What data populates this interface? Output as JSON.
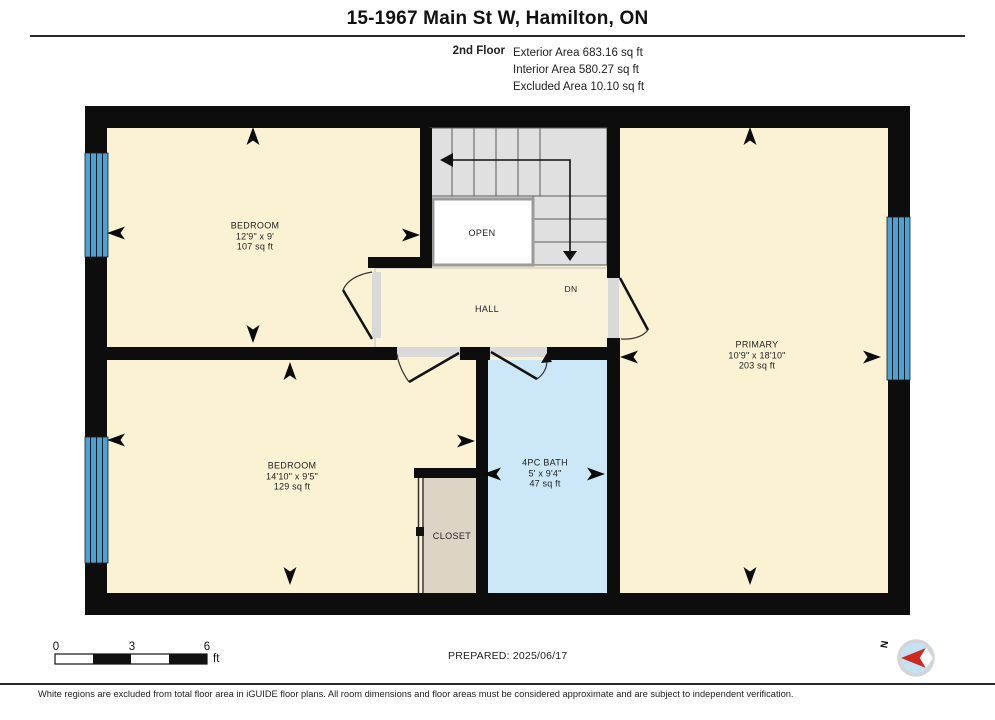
{
  "title": "15-1967 Main St W, Hamilton, ON",
  "floor": {
    "name": "2nd Floor",
    "exterior": "Exterior Area 683.16 sq ft",
    "interior": "Interior Area 580.27 sq ft",
    "excluded": "Excluded Area 10.10 sq ft"
  },
  "rooms": {
    "bedroom1": {
      "name": "BEDROOM",
      "dims": "12'9\" x 9'",
      "area": "107 sq ft"
    },
    "bedroom2": {
      "name": "BEDROOM",
      "dims": "14'10\" x 9'5\"",
      "area": "129 sq ft"
    },
    "primary": {
      "name": "PRIMARY",
      "dims": "10'9\" x 18'10\"",
      "area": "203 sq ft"
    },
    "bath": {
      "name": "4PC BATH",
      "dims": "5' x 9'4\"",
      "area": "47 sq ft"
    },
    "hall": {
      "name": "HALL"
    },
    "open": {
      "name": "OPEN"
    },
    "closet": {
      "name": "CLOSET"
    },
    "stairs_direction": {
      "name": "DN"
    }
  },
  "scale_bar": {
    "start": "0",
    "mid": "3",
    "end": "6",
    "unit": "ft"
  },
  "prepared": "PREPARED: 2025/06/17",
  "compass": {
    "north_label": "N"
  },
  "disclaimer": "White regions are excluded from total floor area in iGUIDE floor plans. All room dimensions and floor areas must be considered approximate and are subject to independent verification.",
  "colors": {
    "wall": "#0d0d0d",
    "room_fill": "#fbf2d3",
    "hall_fill": "#faf3da",
    "bath_fill": "#cbe7f8",
    "window_blue": "#4aa3d8",
    "stair_gray": "#e0e0e0",
    "closet_fill": "#dcd4c5",
    "jamb_gray": "#d9d9d9",
    "open_fill": "#ffffff",
    "compass_blue": "#c3e2f4",
    "compass_needle_red": "#cc2a1e"
  }
}
